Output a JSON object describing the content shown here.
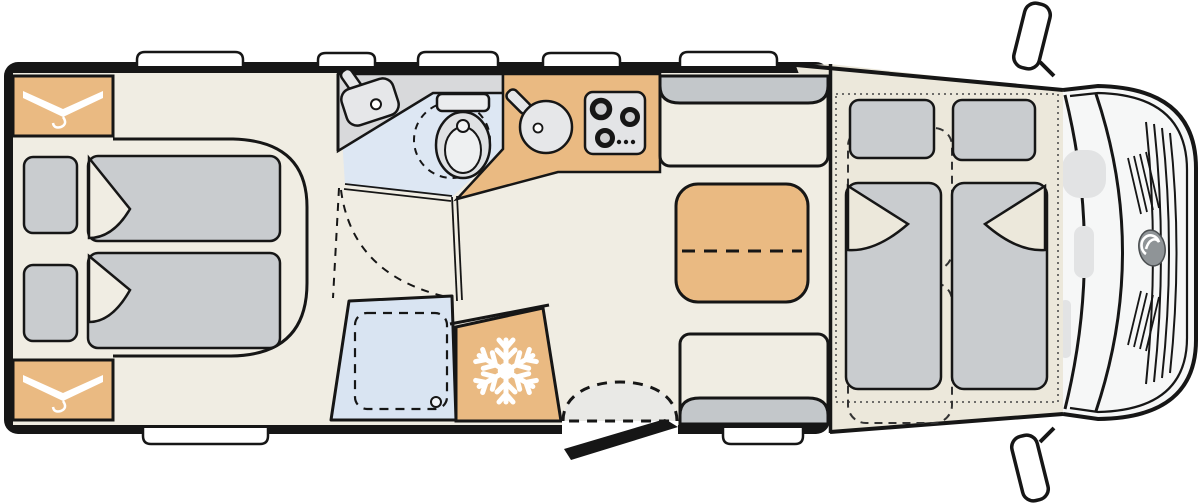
{
  "colors": {
    "wall": "#161616",
    "floor": "#f0ede3",
    "cab_floor": "#ece8db",
    "furniture_tan": "#eaba82",
    "soft_gray": "#c9cccf",
    "bench_gray": "#c3c7ca",
    "bath_floor": "#dde7f3",
    "shower_tray": "#d9e4f2",
    "counter_gray": "#d8d9db",
    "appliance_gray": "#e6e7e9",
    "hob_gray": "#e3e4e6",
    "hood_white": "#f6f7f7",
    "detail_gray": "#e2e3e4",
    "logo_gray": "#8f9497",
    "step_gray": "#e9e9e6",
    "white": "#ffffff"
  },
  "icons": {
    "wardrobe_top": "hanger-icon",
    "wardrobe_bottom": "hanger-icon",
    "refrigerator": "snowflake-icon",
    "front_grille": "brand-logo-icon"
  }
}
